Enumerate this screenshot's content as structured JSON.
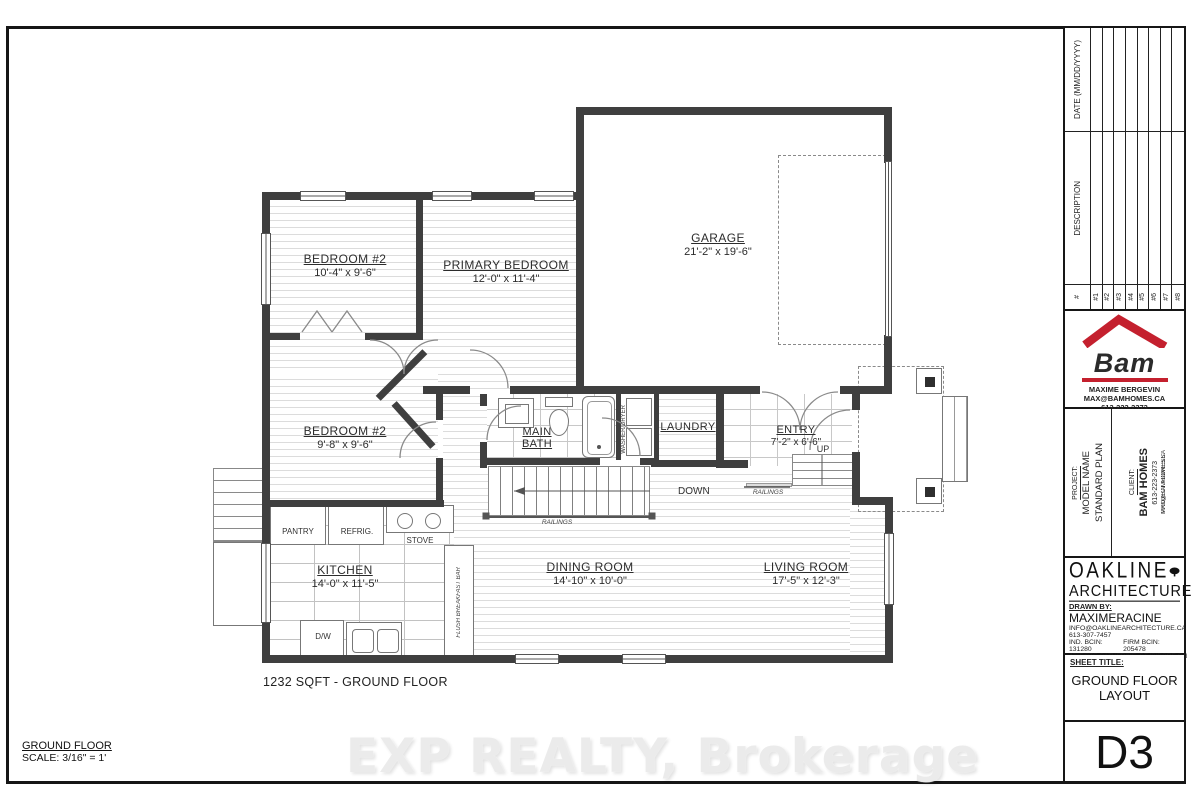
{
  "sheet": {
    "area_note": "1232 SQFT - GROUND FLOOR",
    "scale_title": "GROUND FLOOR",
    "scale_value": "SCALE: 3/16\" = 1'",
    "watermark": "EXP REALTY, Brokerage"
  },
  "colors": {
    "wall": "#3f3f3f",
    "accent_red": "#c4202e"
  },
  "rooms": [
    {
      "name": "BEDROOM #2",
      "dims": "10'-4\" x 9'-6\""
    },
    {
      "name": "PRIMARY BEDROOM",
      "dims": "12'-0\" x 11'-4\""
    },
    {
      "name": "GARAGE",
      "dims": "21'-2\" x 19'-6\""
    },
    {
      "name": "BEDROOM #2",
      "dims": "9'-8\" x 9'-6\""
    },
    {
      "name": "MAIN BATH",
      "dims": ""
    },
    {
      "name": "LAUNDRY",
      "dims": ""
    },
    {
      "name": "ENTRY",
      "dims": "7'-2\" x 6'-6\""
    },
    {
      "name": "KITCHEN",
      "dims": "14'-0\" x 11'-5\""
    },
    {
      "name": "DINING ROOM",
      "dims": "14'-10\" x 10'-0\""
    },
    {
      "name": "LIVING ROOM",
      "dims": "17'-5\" x 12'-3\""
    }
  ],
  "fixtures": {
    "pantry": "PANTRY",
    "fridge": "REFRIG.",
    "stove": "STOVE",
    "dishwasher": "D/W",
    "washer_dryer": "WASHER/DRYER",
    "breakfast_bar": "FLUSH BREAKFAST BAR"
  },
  "stairs": {
    "down": "DOWN",
    "up": "UP",
    "railings_main": "RAILINGS",
    "railings_entry": "RAILINGS"
  },
  "titleblock": {
    "revisions": {
      "date_header": "DATE (MM/DD/YYYY)",
      "description_header": "DESCRIPTION",
      "number_header": "#",
      "rows": [
        "#1",
        "#2",
        "#3",
        "#4",
        "#5",
        "#6",
        "#7",
        "#8"
      ]
    },
    "bam": {
      "logo_text": "Bam",
      "contact_name": "MAXIME BERGEVIN",
      "email": "MAX@BAMHOMES.CA",
      "phone": "613-223-2373"
    },
    "project": {
      "label": "PROJECT:",
      "line1": "MODEL NAME",
      "line2": "STANDARD PLAN"
    },
    "client": {
      "label": "CLIENT:",
      "name": "BAM HOMES",
      "phone": "613-223-2373",
      "overlay1": "PROJECT ADDRESS:",
      "overlay2": "MAX@BAMHOMES.CA"
    },
    "firm": {
      "name_line1": "OAKLINE",
      "name_line2": "ARCHITECTURE",
      "drawn_by_label": "DRAWN BY:",
      "drawn_by": "MAXIMERACINE",
      "email": "INFO@OAKLINEARCHITECTURE.CA",
      "phone": "613-307-7457",
      "ind_bcin": "IND. BCIN: 131280",
      "firm_bcin": "FIRM BCIN: 205478",
      "address": "4725 STE-CATHERINE, ST-ISIDORE ON"
    },
    "sheet_title_label": "SHEET TITLE:",
    "sheet_title_line1": "GROUND FLOOR",
    "sheet_title_line2": "LAYOUT",
    "sheet_number": "D3"
  }
}
